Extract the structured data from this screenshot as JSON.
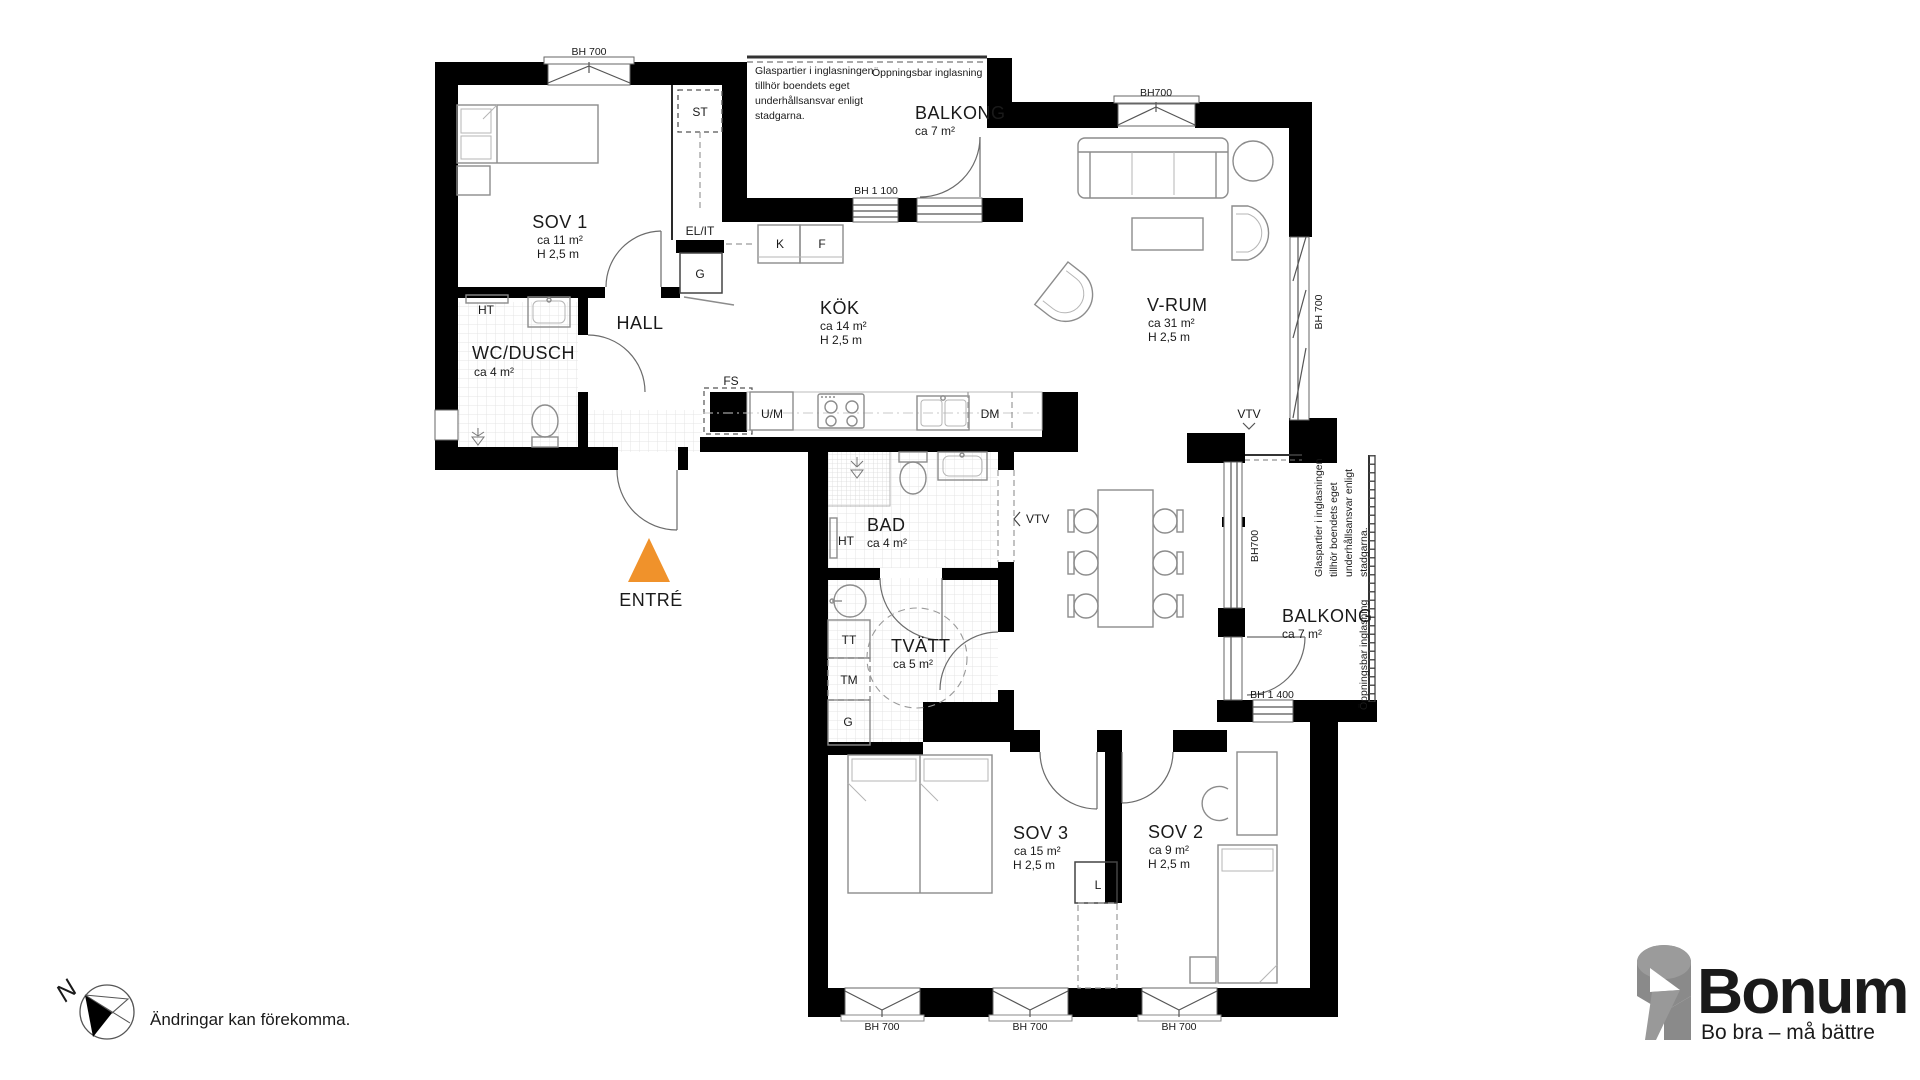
{
  "colors": {
    "wall": "#000000",
    "entre_arrow": "#F0922B",
    "logo_orange": "#F59C20",
    "logo_gray": "#8A8A8A",
    "furniture": "#8C8C8C",
    "tile": "#E2E2E2"
  },
  "rooms": {
    "sov1": {
      "name": "SOV 1",
      "area": "ca 11 m²",
      "height": "H 2,5 m"
    },
    "wc": {
      "name": "WC/DUSCH",
      "area": "ca 4 m²"
    },
    "hall": {
      "name": "HALL"
    },
    "kok": {
      "name": "KÖK",
      "area": "ca 14 m²",
      "height": "H 2,5 m"
    },
    "balkong_top": {
      "name": "BALKONG",
      "area": "ca 7 m²"
    },
    "vrum": {
      "name": "V-RUM",
      "area": "ca 31 m²",
      "height": "H 2,5 m"
    },
    "bad": {
      "name": "BAD",
      "area": "ca 4 m²"
    },
    "tvatt": {
      "name": "TVÄTT",
      "area": "ca 5 m²"
    },
    "sov3": {
      "name": "SOV 3",
      "area": "ca 15 m²",
      "height": "H 2,5 m"
    },
    "sov2": {
      "name": "SOV 2",
      "area": "ca 9 m²",
      "height": "H 2,5 m"
    },
    "balkong_right": {
      "name": "BALKONG",
      "area": "ca 7 m²"
    },
    "entre": {
      "name": "ENTRÉ"
    }
  },
  "fixtures": {
    "st": "ST",
    "elit": "EL/IT",
    "g_hall": "G",
    "k": "K",
    "f": "F",
    "ht_wc": "HT",
    "ht_bad": "HT",
    "fs": "FS",
    "um": "U/M",
    "dm": "DM",
    "vtv_top": "VTV",
    "vtv_bad": "VTV",
    "tt": "TT",
    "tm": "TM",
    "g_tvatt": "G",
    "l": "L"
  },
  "dimensions": {
    "bh700_sov1": "BH 700",
    "bh700_vrum_top": "BH700",
    "bh1100": "BH 1 100",
    "bh700_vrum_right": "BH 700",
    "bh700_balkong_right": "BH700",
    "bh1400": "BH 1 400",
    "bh700_bottom_1": "BH 700",
    "bh700_bottom_2": "BH 700",
    "bh700_bottom_3": "BH 700"
  },
  "notes": {
    "glazing_lines": [
      "Glaspartier i inglasningen",
      "tillhör boendets eget",
      "underhållsansvar enligt",
      "stadgarna."
    ],
    "openable": "Öppningsbar inglasning"
  },
  "footer": {
    "north_letter": "N",
    "disclaimer": "Ändringar kan förekomma."
  },
  "logo": {
    "brand": "Bonum",
    "tagline": "Bo bra – må bättre"
  }
}
